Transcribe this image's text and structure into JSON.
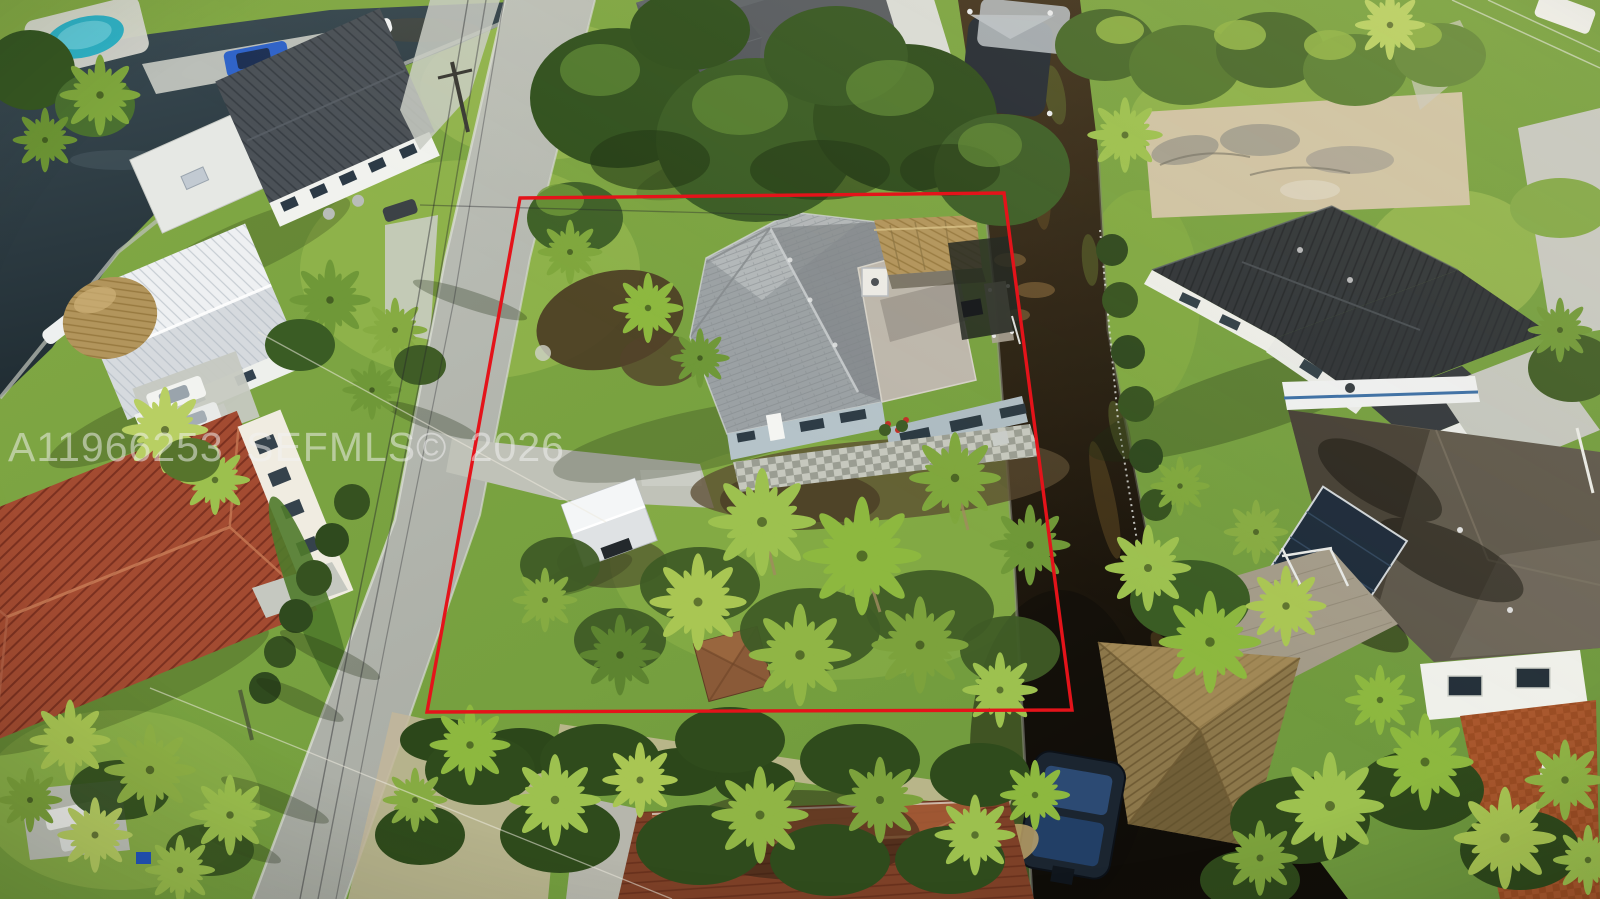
{
  "image": {
    "type": "aerial-real-estate-listing-photo",
    "description": "Oblique aerial drone photo of a waterfront single-family home lot outlined in red, bordered by a street on the left and a dark canal on the right, surrounded by palm trees and neighboring houses."
  },
  "watermark": {
    "text": "A11966253 SEFMLS© 2026",
    "color": "#f2f2f2",
    "opacity": 0.52
  },
  "boundary": {
    "label": "property-boundary",
    "color": "#e4131a",
    "points": "520,198 1004,193 1072,710 427,712"
  },
  "scene": {
    "subject_house": "gray shingle roof house with light-blue walls, white chimney, flat rear roof, tiki hut and rear patio",
    "street": "diagonal residential street lower-left",
    "canal": "dark brown canal water running down the right side",
    "neighbors": [
      "white house with dark metal roof and pool (top left)",
      "white standing-seam metal gable roof house (left)",
      "terracotta spanish-tile roof house (bottom left)",
      "brick house with dark shingle roof and turret (top center)",
      "black standing-seam metal roof house (right)",
      "brown shingle roof house with white walls and paver drive (bottom right)",
      "brown roof house (bottom center)"
    ],
    "details": [
      "boats on lifts in canal",
      "docks with thatched tiki hut",
      "power lines along street",
      "sand/dirt cleared lot top right"
    ],
    "palette": {
      "grass": "#7ba341",
      "canal_water": "#241b10",
      "road": "#b5b8b0",
      "subject_roof": "#9ba1a4",
      "tile_roof": "#a34b31",
      "black_metal_roof": "#2e3337",
      "thatch": "#b2955c",
      "boundary_red": "#e4131a"
    }
  }
}
